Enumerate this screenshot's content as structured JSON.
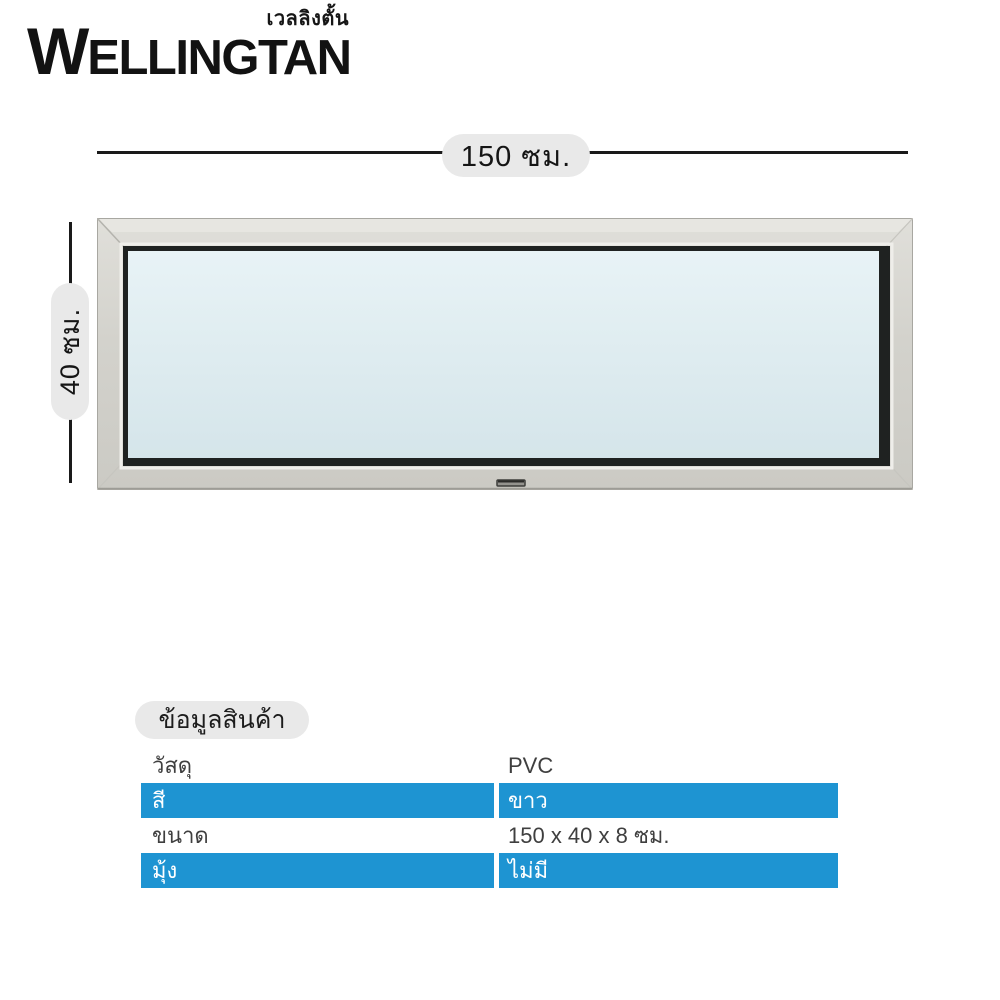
{
  "brand": {
    "thai_name": "เวลลิงตั้น",
    "name_initial": "W",
    "name_rest": "ELLINGTAN"
  },
  "dimensions": {
    "width_label": "150 ซม.",
    "height_label": "40 ซม."
  },
  "window": {
    "frame_color": "#d3d2cc",
    "glass_color": "#dfedf1",
    "glazing_border_color": "#1f2221"
  },
  "product_info": {
    "header": "ข้อมูลสินค้า",
    "rows": [
      {
        "label": "วัสดุ",
        "value": "PVC"
      },
      {
        "label": "สี",
        "value": "ขาว"
      },
      {
        "label": "ขนาด",
        "value": "150 x 40 x 8 ซม."
      },
      {
        "label": "มุ้ง",
        "value": "ไม่มี"
      }
    ]
  },
  "colors": {
    "accent_blue": "#1e94d2",
    "pill_gray": "#e9e9e9",
    "dimension_line": "#1a1a1a",
    "text_dark": "#3f3f3f",
    "text_on_blue": "#ffffff"
  }
}
